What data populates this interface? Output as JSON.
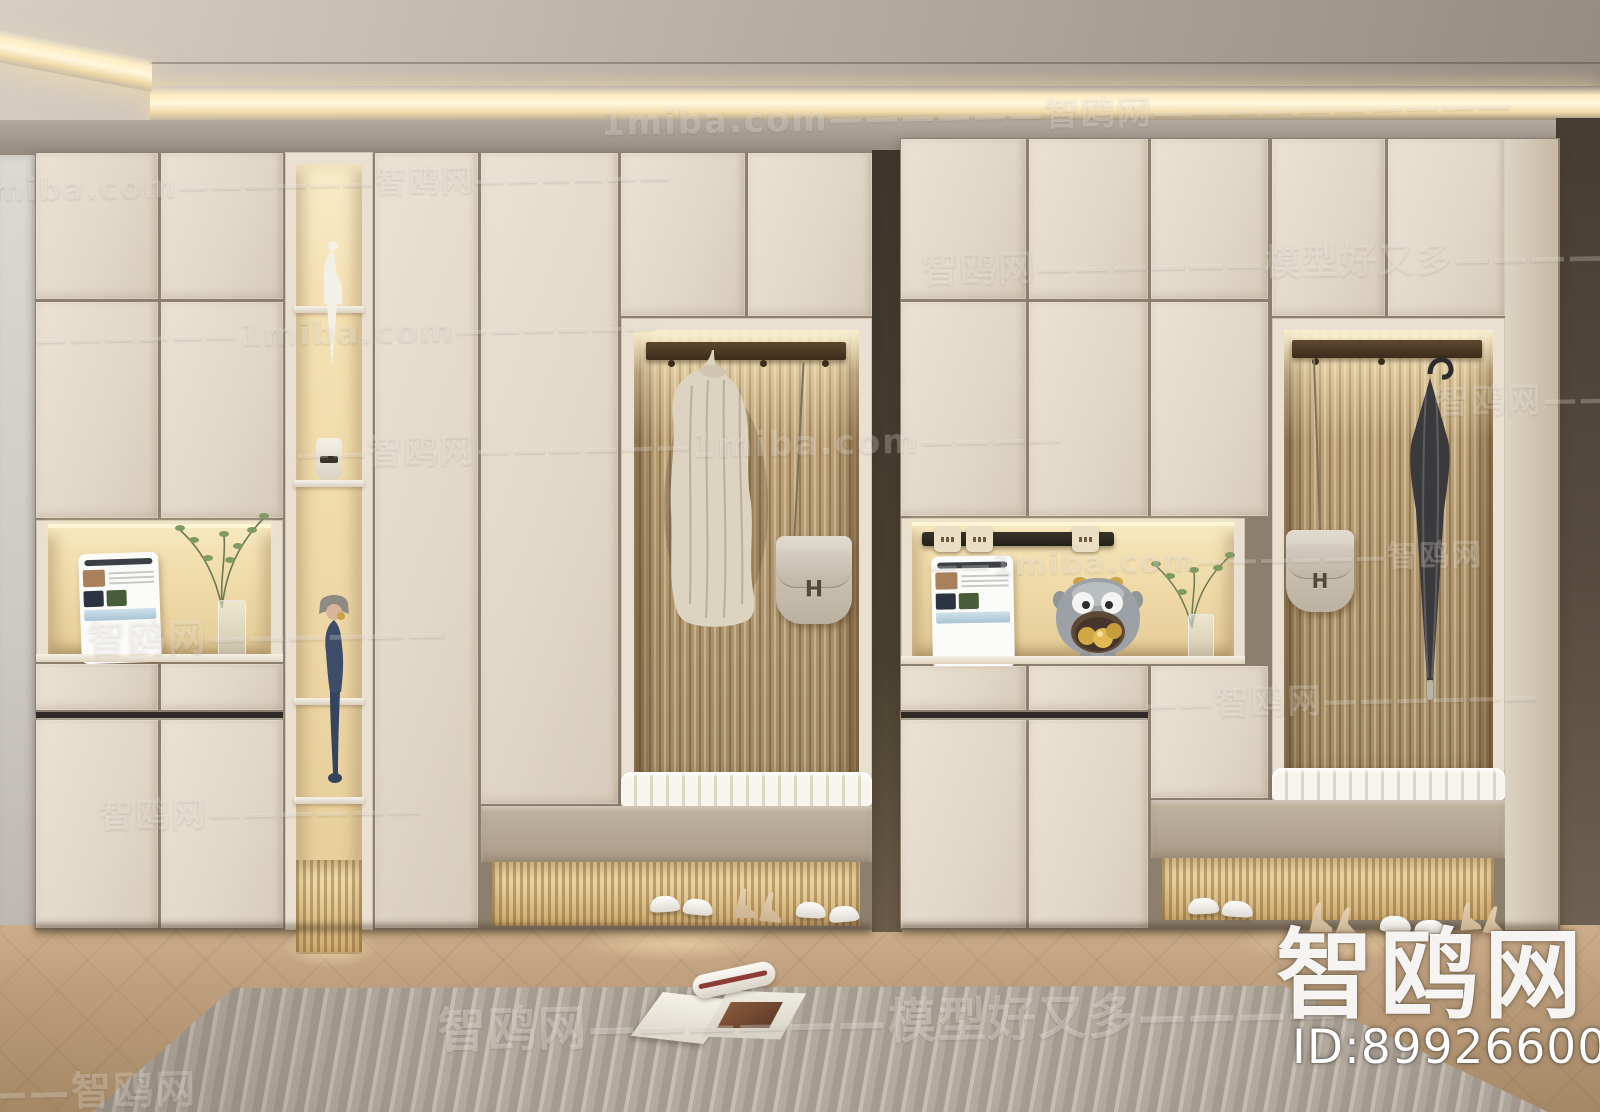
{
  "watermarks": {
    "site": "1miba.com",
    "brand": "智鸥网",
    "slogan": "模型好又多",
    "items": [
      {
        "text": "1miba.com——————智鸥网——————————",
        "x": 610,
        "y": 92,
        "size": 34
      },
      {
        "text": "——1miba.com——————智鸥网——————",
        "x": -90,
        "y": 148,
        "size": 31
      },
      {
        "text": "智鸥网——————模型好又多——————",
        "x": 928,
        "y": 244,
        "size": 36
      },
      {
        "text": "——————1miba.com——————",
        "x": 40,
        "y": 304,
        "size": 32
      },
      {
        "text": "——智鸥网——————1miba.com————",
        "x": 298,
        "y": 416,
        "size": 34
      },
      {
        "text": "智鸥网————",
        "x": 1438,
        "y": 388,
        "size": 34
      },
      {
        "text": "智鸥网——————",
        "x": 86,
        "y": 594,
        "size": 38
      },
      {
        "text": "——1miba.com——————智鸥网",
        "x": 928,
        "y": 544,
        "size": 30
      },
      {
        "text": "——智鸥网——————",
        "x": 1140,
        "y": 684,
        "size": 34
      },
      {
        "text": "智鸥网——————",
        "x": 94,
        "y": 774,
        "size": 34
      },
      {
        "text": "智鸥网——————模型好又多————",
        "x": 428,
        "y": 984,
        "size": 48,
        "opacity": 0.5
      },
      {
        "text": "—————智鸥网",
        "x": -150,
        "y": 1044,
        "size": 40
      }
    ]
  },
  "logo": {
    "brand": "智鸥网",
    "id": "ID:899266006"
  },
  "bag": {
    "monogram": "H"
  },
  "palette": {
    "cabinet_cream": "#e7decf",
    "niche_glow": "#f2dfae",
    "flute_wood": "#b1976d",
    "wood_floor": "#b9976f",
    "rug_gray": "#b5aca1",
    "ceiling": "#b4aba0",
    "led_warm": "#ffeec8",
    "dark_wall": "#4c4338",
    "rail_walnut": "#4d3a28",
    "bench_white": "#f6f3ec"
  },
  "scene": {
    "objects": [
      "entryway-wardrobe-cabinets",
      "backlit-display-niches",
      "fluted-slat-panels",
      "knit-coat",
      "h-buckle-handbag",
      "umbrella",
      "tablet",
      "plant-in-vase",
      "white-figurine",
      "blue-doll-figurine",
      "bull-ornament-with-gold-eggs",
      "power-track-sockets",
      "bench-cushion",
      "sneakers",
      "high-heels",
      "striped-rug",
      "open-magazine",
      "herringbone-wood-floor",
      "cove-lighting"
    ]
  }
}
